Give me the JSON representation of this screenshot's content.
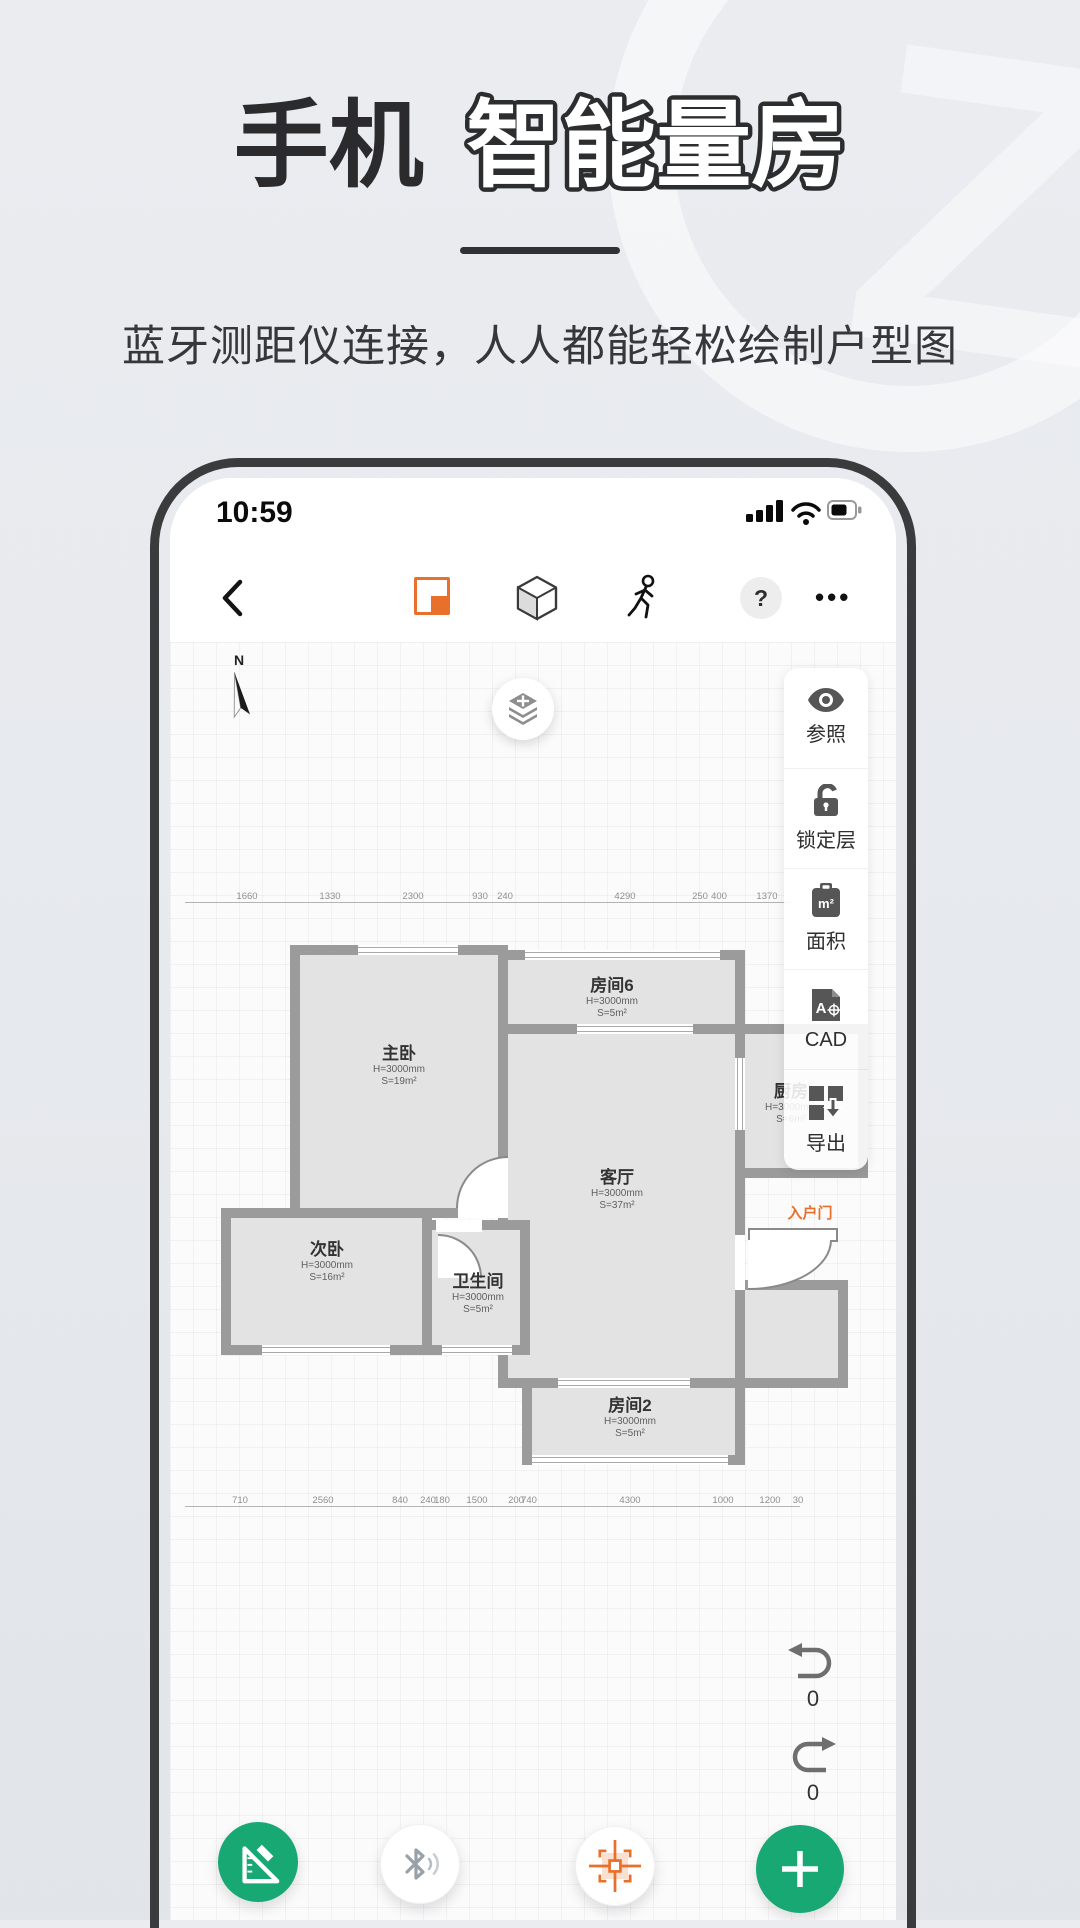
{
  "hero": {
    "title_prefix": "手机",
    "title_main": "智能量房",
    "subtitle": "蓝牙测距仪连接，人人都能轻松绘制户型图"
  },
  "statusbar": {
    "time": "10:59"
  },
  "toolbar": {
    "help": "?",
    "more": "•••"
  },
  "canvas": {
    "compass": "N",
    "entrance": "入户门",
    "undo_count": "0",
    "redo_count": "0"
  },
  "sidebar": {
    "area_unit": "m²",
    "cad_letter": "A",
    "items": [
      {
        "icon": "eye-icon",
        "label": "参照"
      },
      {
        "icon": "lock-open-icon",
        "label": "锁定层"
      },
      {
        "icon": "area-icon",
        "label": "面积"
      },
      {
        "icon": "cad-file-icon",
        "label": "CAD"
      },
      {
        "icon": "export-icon",
        "label": "导出"
      }
    ]
  },
  "rooms": [
    {
      "name": "主卧",
      "h": "H=3000mm",
      "s": "S=19m²"
    },
    {
      "name": "房间6",
      "h": "H=3000mm",
      "s": "S=5m²"
    },
    {
      "name": "厨房",
      "h": "H=3000mm",
      "s": "S=6m²"
    },
    {
      "name": "客厅",
      "h": "H=3000mm",
      "s": "S=37m²"
    },
    {
      "name": "次卧",
      "h": "H=3000mm",
      "s": "S=16m²"
    },
    {
      "name": "卫生间",
      "h": "H=3000mm",
      "s": "S=5m²"
    },
    {
      "name": "房间2",
      "h": "H=3000mm",
      "s": "S=5m²"
    }
  ],
  "dims": {
    "top": [
      "1660",
      "1330",
      "2300",
      "930",
      "240",
      "4290",
      "250",
      "400",
      "1370"
    ],
    "bottom": [
      "710",
      "2560",
      "840",
      "240",
      "180",
      "1500",
      "200",
      "740",
      "4300",
      "1000",
      "1200",
      "30"
    ]
  },
  "colors": {
    "accent_orange": "#e8702a",
    "accent_green": "#18a873",
    "wall_gray": "#9b9b9b",
    "frame_dark": "#3a3b3d"
  }
}
